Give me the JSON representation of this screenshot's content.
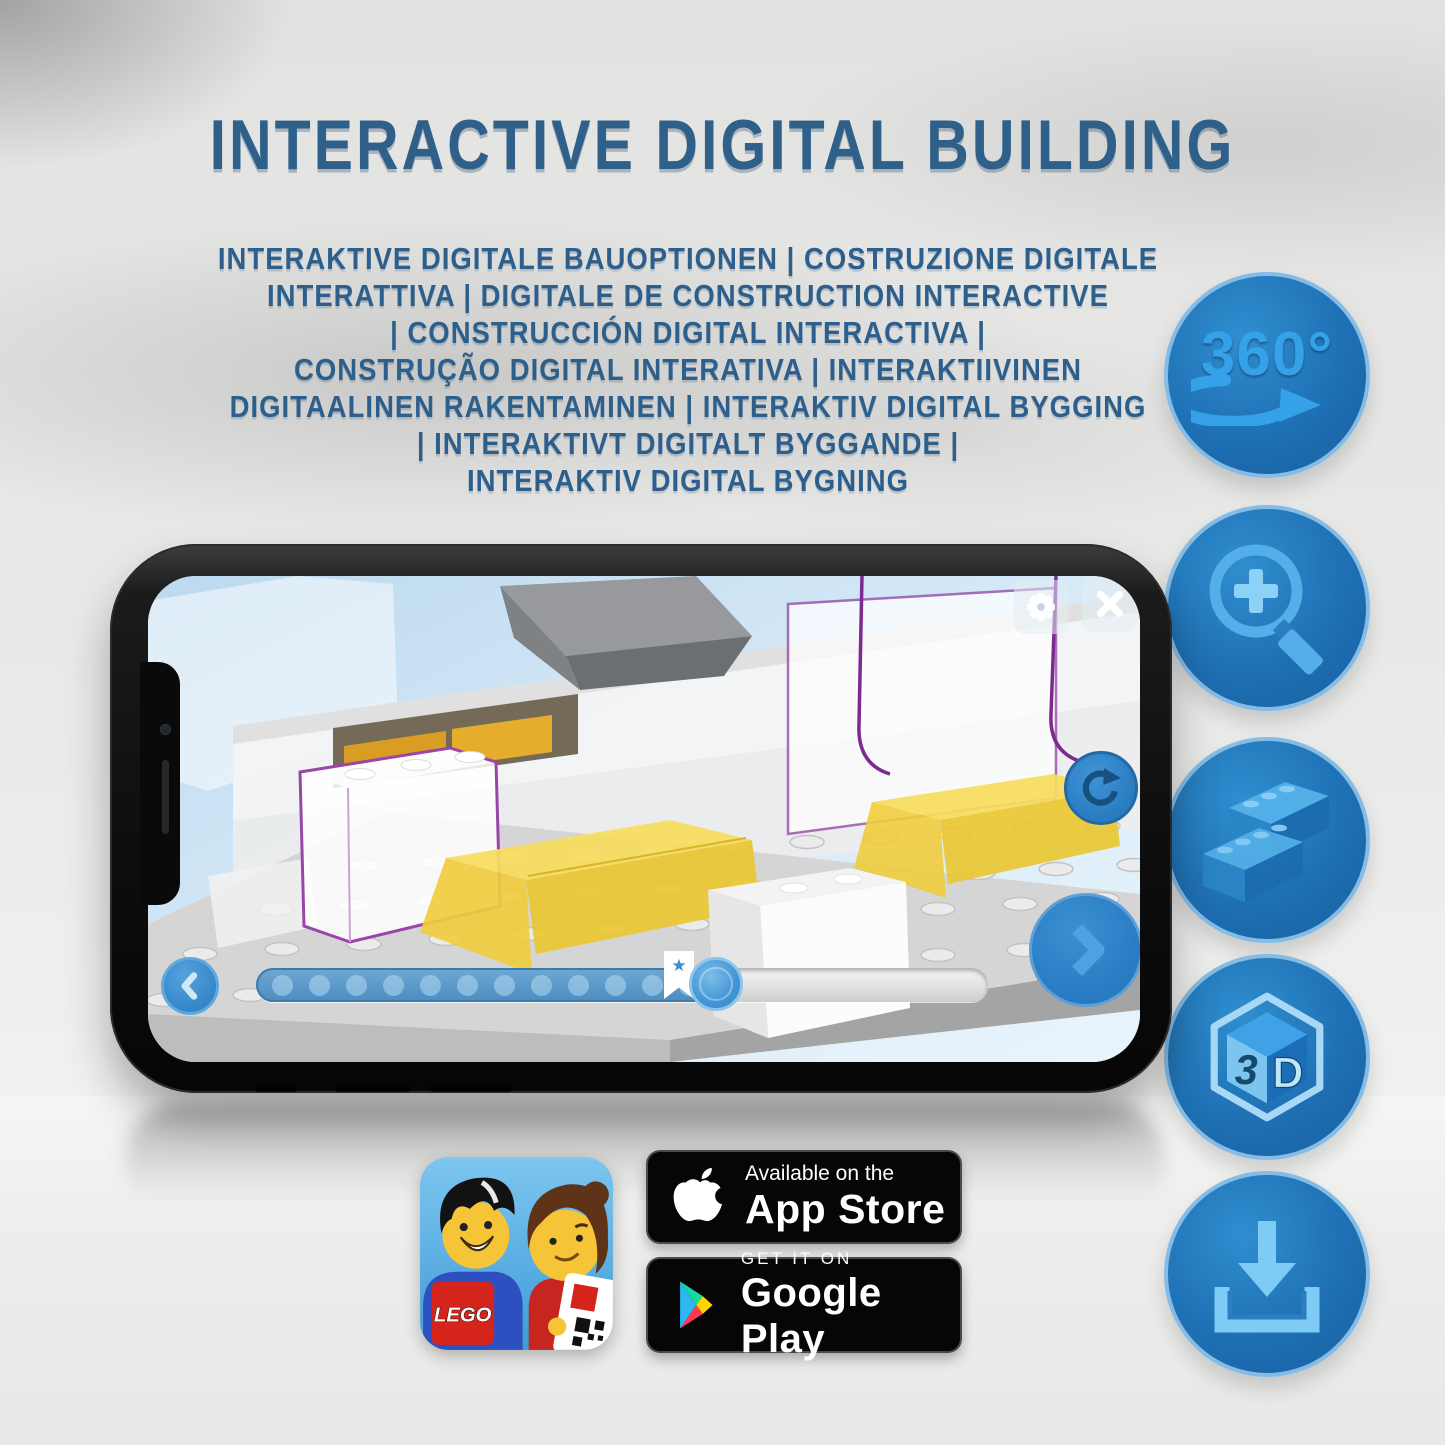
{
  "header": {
    "title": "INTERACTIVE DIGITAL BUILDING",
    "subtitle_lines": [
      "INTERAKTIVE DIGITALE BAUOPTIONEN | COSTRUZIONE DIGITALE",
      "INTERATTIVA | DIGITALE DE CONSTRUCTION INTERACTIVE",
      "| CONSTRUCCIÓN DIGITAL INTERACTIVA |",
      "CONSTRUÇÃO DIGITAL INTERATIVA | INTERAKTIIVINEN",
      "DIGITAALINEN RAKENTAMINEN | INTERAKTIV DIGITAL BYGGING",
      "| INTERAKTIVT DIGITALT BYGGANDE |",
      "INTERAKTIV DIGITAL BYGNING"
    ],
    "title_color": "#2e6089"
  },
  "feature_icons": {
    "rotate_label": "360°",
    "cube_3": "3",
    "cube_d": "D",
    "names": [
      "360-rotation",
      "zoom-in",
      "lego-bricks",
      "3d-view",
      "download"
    ]
  },
  "phone": {
    "slider": {
      "star": "★"
    }
  },
  "app_icon": {
    "logo_text": "LEGO"
  },
  "store_badges": {
    "app_store": {
      "tagline": "Available on the",
      "name": "App Store"
    },
    "google_play": {
      "tagline": "GET IT ON",
      "name": "Google Play"
    }
  },
  "colors": {
    "title_blue": "#2e6089",
    "circle_fill": "#1e6fb3",
    "icon_blue": "#35a1e8",
    "lego_yellow": "#f3d34a",
    "badge_black": "#060606"
  }
}
